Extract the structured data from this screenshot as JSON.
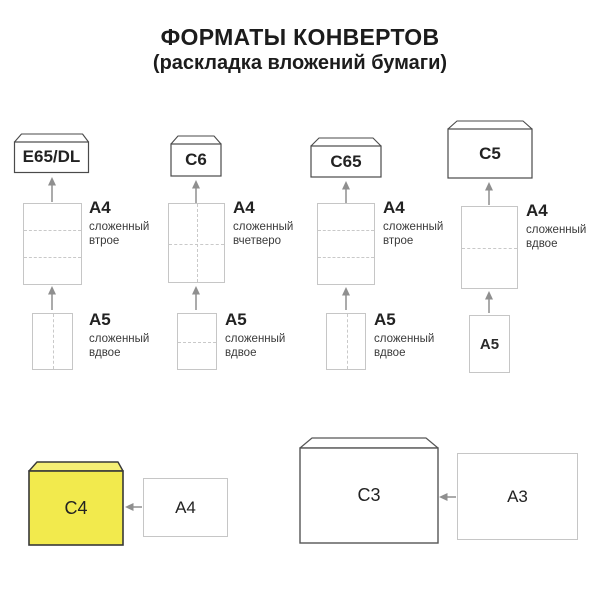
{
  "title": {
    "line1": "ФОРМАТЫ КОНВЕРТОВ",
    "line2": "(раскладка вложений бумаги)"
  },
  "columns": [
    {
      "envelope_label": "E65/DL",
      "paper1_label": "A4",
      "paper1_desc_line1": "сложенный",
      "paper1_desc_line2": "втрое",
      "paper2_label": "A5",
      "paper2_desc_line1": "сложенный",
      "paper2_desc_line2": "вдвое"
    },
    {
      "envelope_label": "C6",
      "paper1_label": "A4",
      "paper1_desc_line1": "сложенный",
      "paper1_desc_line2": "вчетверо",
      "paper2_label": "A5",
      "paper2_desc_line1": "сложенный",
      "paper2_desc_line2": "вдвое"
    },
    {
      "envelope_label": "C65",
      "paper1_label": "A4",
      "paper1_desc_line1": "сложенный",
      "paper1_desc_line2": "втрое",
      "paper2_label": "A5",
      "paper2_desc_line1": "сложенный",
      "paper2_desc_line2": "вдвое"
    },
    {
      "envelope_label": "C5",
      "paper1_label": "A4",
      "paper1_desc_line1": "сложенный",
      "paper1_desc_line2": "вдвое",
      "paper2_label": "A5"
    }
  ],
  "bottom_row": {
    "envelope_c4_label": "C4",
    "paper_a4_label": "A4",
    "envelope_c3_label": "C3",
    "paper_a3_label": "A3"
  },
  "colors": {
    "envelope_c4_fill": "#f2ea4d",
    "envelope_c4_flap_fill": "#f5ef75",
    "envelope_border": "#4a4a4a",
    "sheet_border": "#c6c6c6",
    "fold_dash": "#c9c9c9",
    "arrow": "#8f8f8f",
    "text": "#1e1e1e"
  }
}
